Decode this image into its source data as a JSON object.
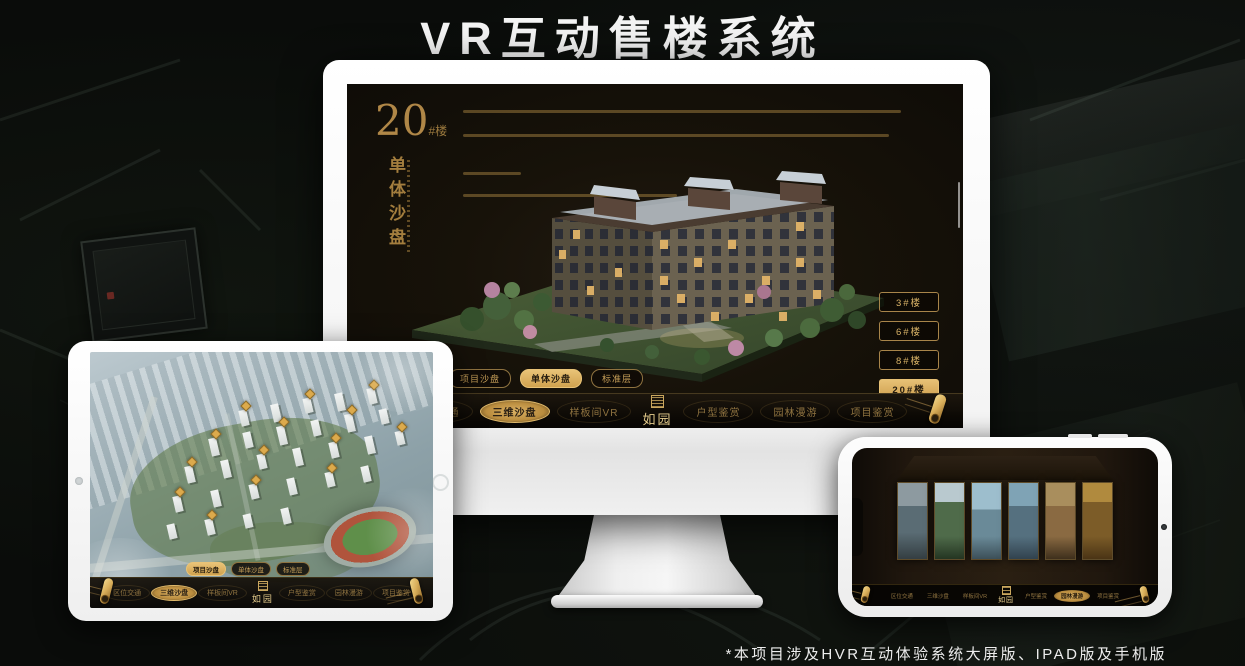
{
  "title": "VR互动售楼系统",
  "footnote": "*本项目涉及HVR互动体验系统大屏版、IPAD版及手机版",
  "colors": {
    "gold": "#c79f58",
    "gold_selected": "#e0b766",
    "screen_background": "#14100a",
    "device_body": "#f4f4f4"
  },
  "nav": {
    "items": [
      "区位交通",
      "三维沙盘",
      "样板间VR",
      "户型鉴赏",
      "园林漫游",
      "项目鉴赏"
    ],
    "logo": "如园"
  },
  "sub_tabs": [
    {
      "label": "项目沙盘"
    },
    {
      "label": "单体沙盘"
    },
    {
      "label": "标准层"
    }
  ],
  "monitor": {
    "heading_number": "20",
    "heading_unit": "#楼",
    "heading_vertical": "单体沙盘",
    "selected_sub_tab": "单体沙盘",
    "selected_nav": "三维沙盘",
    "selected_floor": "20#楼",
    "floor_buttons": [
      {
        "label": "3#楼",
        "selected": false
      },
      {
        "label": "6#楼",
        "selected": false
      },
      {
        "label": "8#楼",
        "selected": false
      },
      {
        "label": "20#楼",
        "selected": true
      }
    ]
  },
  "tablet": {
    "selected_sub_tab": "项目沙盘",
    "selected_nav": "三维沙盘"
  },
  "phone": {
    "selected_nav": "园林漫游"
  }
}
